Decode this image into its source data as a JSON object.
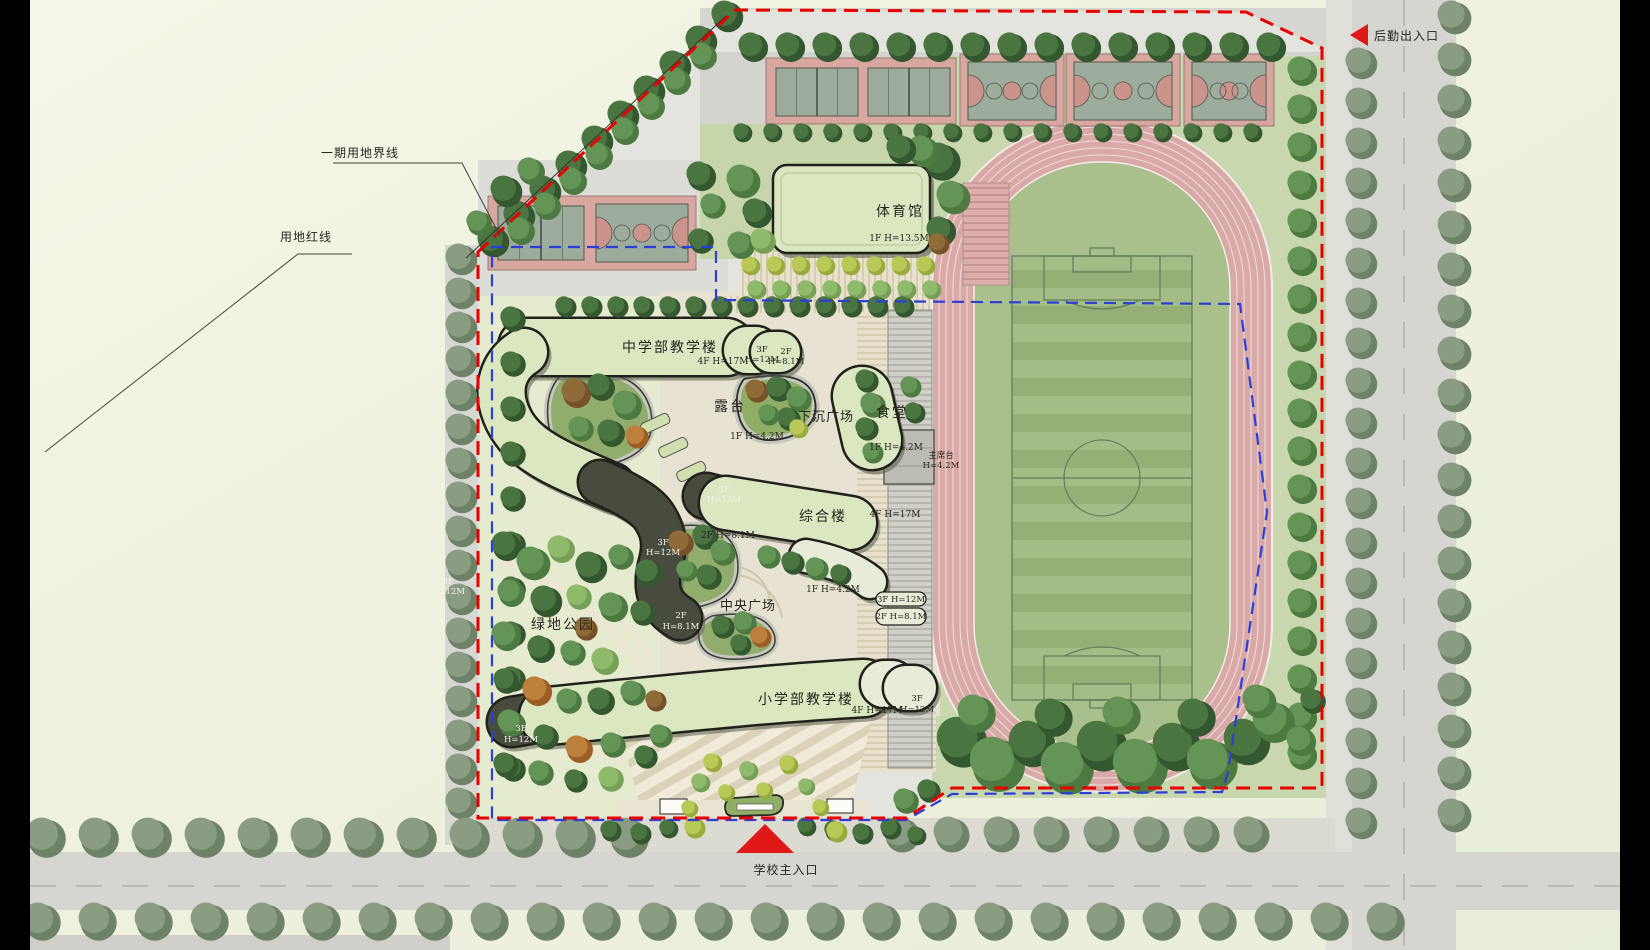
{
  "plan": {
    "annotations": {
      "phase1_boundary": "一期用地界线",
      "red_line": "用地红线"
    },
    "entrances": {
      "service": "后勤出入口",
      "main": "学校主入口"
    },
    "gym": {
      "name": "体育馆",
      "spec": "1F  H=13.5M"
    },
    "middle_school": {
      "name": "中学部教学楼",
      "spec": "4F  H=17M",
      "step3_f": "3F",
      "step3_h": "H=12M",
      "step2_f": "2F",
      "step2_h": "H=8.1M"
    },
    "terrace": {
      "name": "露台",
      "spec": "1F  H=4.2M"
    },
    "sunken_plaza": {
      "name": "下沉广场"
    },
    "canteen": {
      "name": "食堂",
      "spec": "1F  H=4.2M"
    },
    "rostrum": {
      "line1": "主席台",
      "line2": "H=4.2M"
    },
    "complex_bldg": {
      "name": "综合楼",
      "spec": "4F  H=17M",
      "step3_f": "3F",
      "step3_h": "H=12M",
      "spec_2f": "2F  H=8.1M",
      "spec_1f": "1F  H=4.2M",
      "tab_3f": "3F  H=12M",
      "tab_2f": "2F  H=8.1M"
    },
    "central_plaza": {
      "name": "中央广场"
    },
    "green_park": {
      "name": "绿地公园"
    },
    "west_wing": {
      "step3_f": "3F",
      "step3_h": "H=12M",
      "step2_f": "2F",
      "step2_h": "H=8.1M",
      "far_f": "3F",
      "far_h": "H=12M"
    },
    "primary_school": {
      "name": "小学部教学楼",
      "spec": "4F  H=17M",
      "rstep_f": "3F",
      "rstep_h": "H=12M",
      "lstep_f": "3F",
      "lstep_h": "H=12M"
    },
    "colors": {
      "red_boundary": "#e60000",
      "blue_boundary": "#2b3fd6",
      "track_pink": "#d9a9a7",
      "building_green": "#dbe7c1",
      "field_green": "#a4bd87"
    }
  }
}
